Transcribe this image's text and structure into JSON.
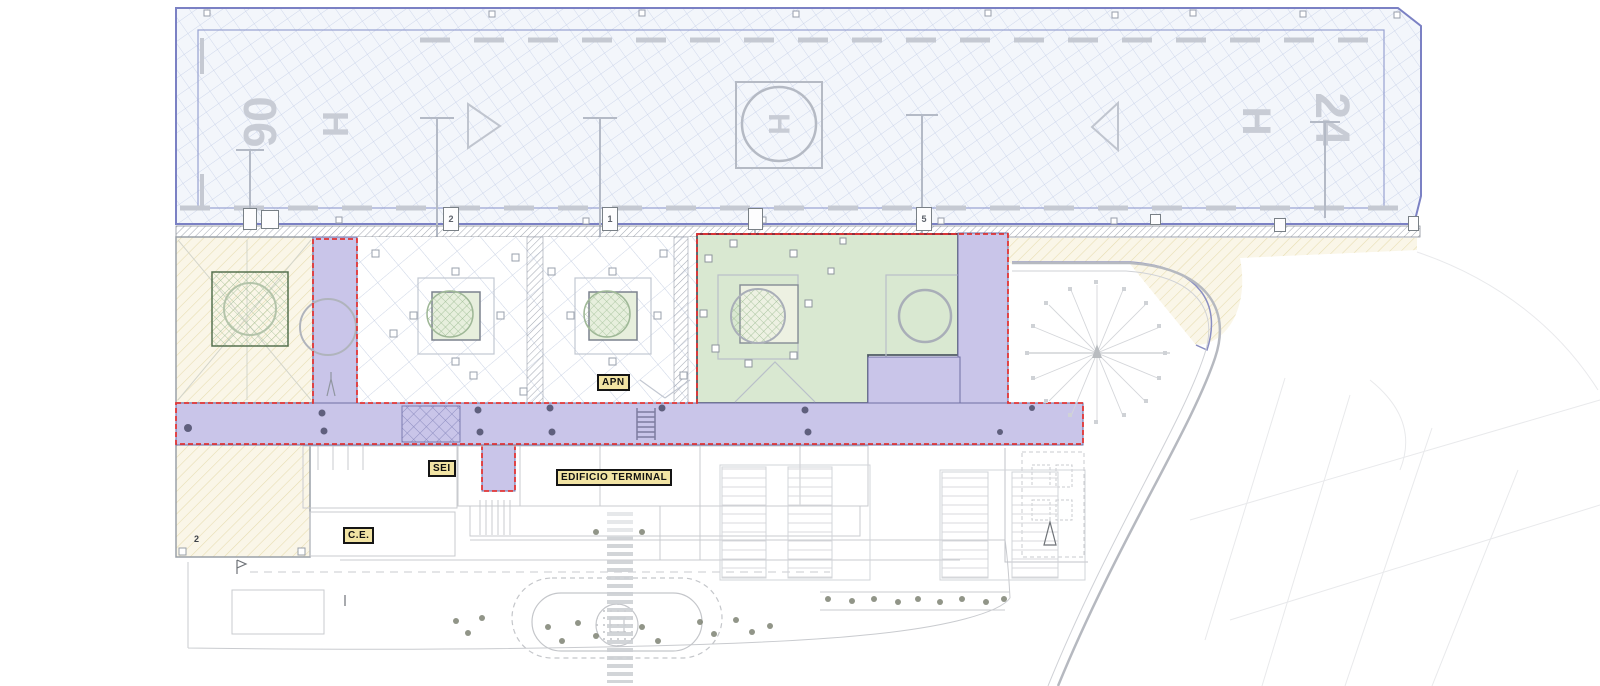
{
  "drawing": {
    "title": "Airport site plan",
    "labels": {
      "apron": "APN",
      "fire_station": "SEI",
      "terminal": "EDIFICIO TERMINAL",
      "ce": "C.E.",
      "area_number": "2"
    },
    "runway": {
      "left_designator": "06",
      "left_h": "H",
      "helipad_h": "H",
      "right_h": "H",
      "right_designator": "24",
      "marker_boxes": [
        {
          "x": 243,
          "y": 208,
          "w": 12,
          "h": 20,
          "label": ""
        },
        {
          "x": 261,
          "y": 210,
          "w": 16,
          "h": 17,
          "label": ""
        },
        {
          "x": 443,
          "y": 207,
          "w": 14,
          "h": 22,
          "label": "2"
        },
        {
          "x": 602,
          "y": 207,
          "w": 14,
          "h": 22,
          "label": "1"
        },
        {
          "x": 748,
          "y": 208,
          "w": 13,
          "h": 20,
          "label": ""
        },
        {
          "x": 916,
          "y": 207,
          "w": 14,
          "h": 22,
          "label": "5"
        },
        {
          "x": 1150,
          "y": 214,
          "w": 9,
          "h": 9,
          "label": ""
        },
        {
          "x": 1274,
          "y": 218,
          "w": 10,
          "h": 12,
          "label": ""
        },
        {
          "x": 1408,
          "y": 216,
          "w": 9,
          "h": 13,
          "label": ""
        }
      ]
    },
    "colors": {
      "boundary_red": "#e03434",
      "zone_purple": "#c9c5e9",
      "zone_green": "#d9e8d1",
      "zone_beige": "#faf6e8",
      "label_yellow": "#f2e4a4",
      "runway_border_blue": "#7b81c4",
      "marking_gray": "#c8ccd5"
    }
  }
}
